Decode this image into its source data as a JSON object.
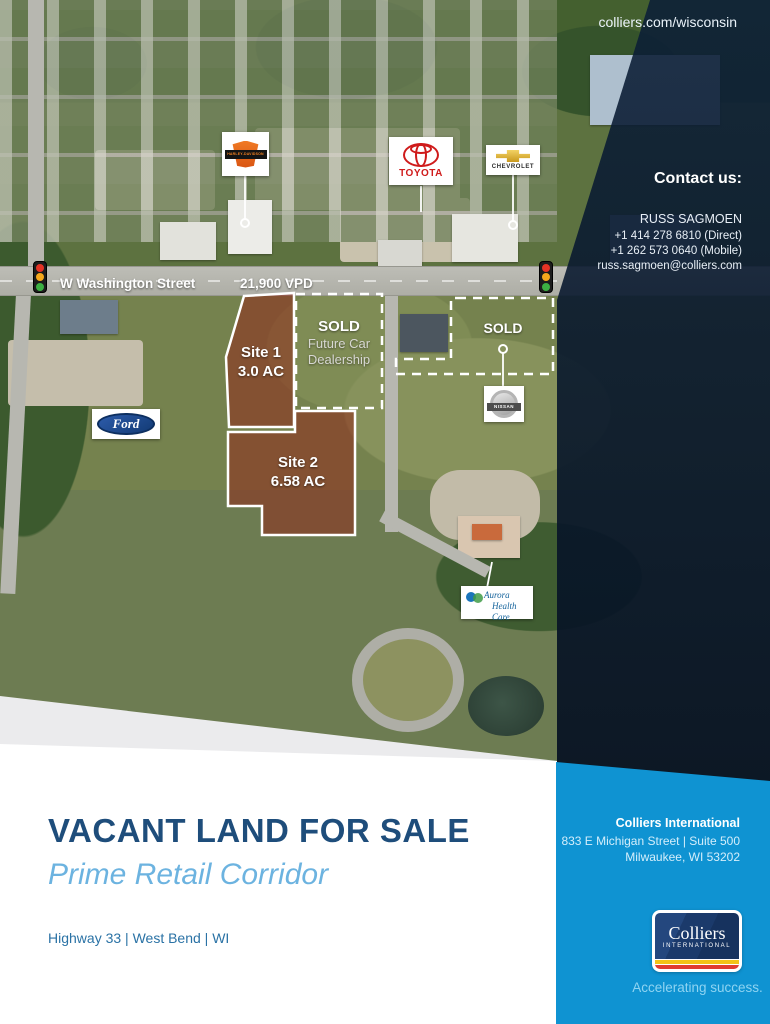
{
  "header": {
    "website": "colliers.com/wisconsin"
  },
  "contact": {
    "heading": "Contact us:",
    "name": "RUSS SAGMOEN",
    "phone_direct": "+1 414 278 6810 (Direct)",
    "phone_mobile": "+1 262 573 0640 (Mobile)",
    "email": "russ.sagmoen@colliers.com"
  },
  "map": {
    "street_label": "W Washington Street",
    "traffic_count": "21,900 VPD",
    "sites": [
      {
        "name": "Site 1",
        "acreage": "3.0 AC"
      },
      {
        "name": "Site 2",
        "acreage": "6.58 AC"
      }
    ],
    "sold_parcels": [
      {
        "label": "SOLD",
        "sub_label": "Future Car Dealership"
      },
      {
        "label": "SOLD"
      }
    ],
    "signs": [
      {
        "brand": "Harley-Davidson",
        "label": "HARLEY-DAVIDSON"
      },
      {
        "brand": "Toyota",
        "label": "TOYOTA"
      },
      {
        "brand": "Chevrolet",
        "label": "CHEVROLET"
      },
      {
        "brand": "Ford",
        "label": "Ford"
      },
      {
        "brand": "Nissan",
        "label": "NISSAN"
      },
      {
        "brand": "Aurora Health Care",
        "label_line1": "Aurora",
        "label_line2": "Health Care"
      }
    ]
  },
  "footer": {
    "title": "VACANT LAND FOR SALE",
    "subtitle": "Prime Retail Corridor",
    "location": "Highway 33 | West Bend | WI",
    "company": {
      "name": "Colliers International",
      "address_line1": "833 E Michigan Street | Suite 500",
      "address_line2": "Milwaukee, WI 53202"
    },
    "logo": {
      "wordmark": "Colliers",
      "sub": "INTERNATIONAL"
    },
    "tagline": "Accelerating success."
  },
  "colors": {
    "brand_blue": "#0f93d2",
    "logo_navy": "#1b3a6b",
    "logo_yellow": "#f3c317",
    "logo_red": "#e03c31",
    "title_blue": "#1e4d7b",
    "subtitle_blue": "#6cb3e0",
    "site_overlay_red": "#8f2a1c"
  }
}
